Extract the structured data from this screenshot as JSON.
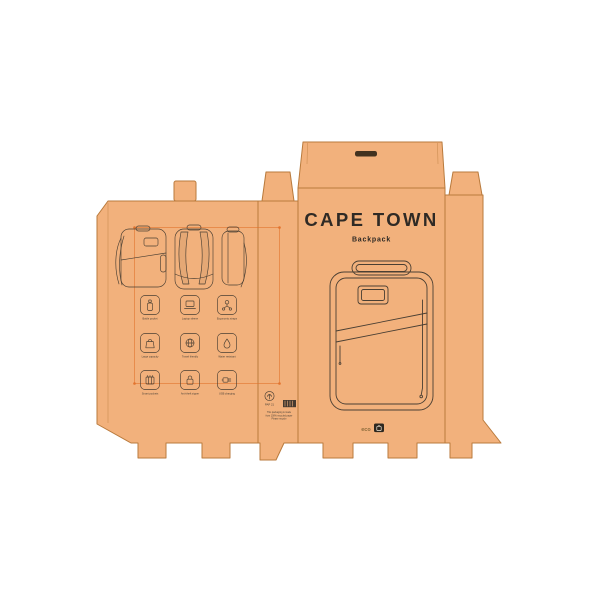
{
  "product": {
    "name": "CAPE TOWN",
    "category": "Backpack"
  },
  "features": {
    "items": [
      {
        "icon": "bottle-icon",
        "label": "Bottle pocket"
      },
      {
        "icon": "laptop-icon",
        "label": "Laptop sleeve"
      },
      {
        "icon": "straps-icon",
        "label": "Ergonomic straps"
      },
      {
        "icon": "bag-icon",
        "label": "Large capacity"
      },
      {
        "icon": "globe-icon",
        "label": "Travel friendly"
      },
      {
        "icon": "droplet-icon",
        "label": "Water resistant"
      },
      {
        "icon": "organizer-icon",
        "label": "Smart pockets"
      },
      {
        "icon": "padlock-icon",
        "label": "Anti-theft zipper"
      },
      {
        "icon": "usb-icon",
        "label": "USB charging"
      }
    ]
  },
  "print_marks": {
    "material_code": "PAP 21",
    "recycle_line1": "This packaging is made",
    "recycle_line2": "from 100% recycled paper",
    "recycle_line3": "Please recycle"
  },
  "brand": {
    "mark": "eco"
  },
  "colors": {
    "kraft": "#f2b17c",
    "outline": "#b97a3c",
    "ink": "#453a2f",
    "accent": "#e2732d",
    "slot": "#42321f",
    "background": "#ffffff"
  }
}
